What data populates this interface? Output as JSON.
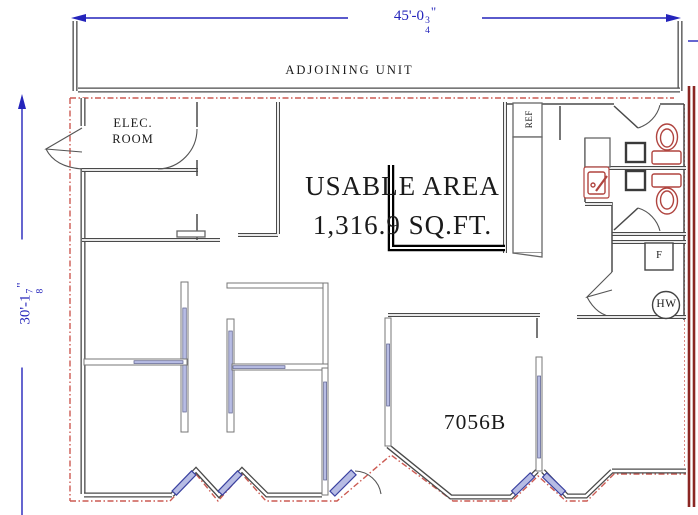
{
  "drawing": {
    "unit_number": "7056B",
    "usable_area": {
      "line1": "USABLE AREA",
      "line2": "1,316.9 SQ.FT."
    },
    "adjoining_unit_label": "ADJOINING UNIT",
    "elec_room": {
      "line1": "ELEC.",
      "line2": "ROOM"
    },
    "fixtures": {
      "refrigerator": "REF",
      "furnace": "F",
      "water_heater": "HW"
    },
    "dimensions": {
      "width": {
        "feet": "45'-0",
        "numerator": "3",
        "denominator": "4",
        "unit_mark": "\""
      },
      "height": {
        "feet": "30'-1",
        "numerator": "7",
        "denominator": "8",
        "unit_mark": "\""
      }
    }
  },
  "colors": {
    "dimension_blue": "#2424bb",
    "wall_gray": "#4a4a4a",
    "demising_red": "#cc5a52",
    "lease_line_dark_red": "#8b2623",
    "partition_blue": "#b7bce4",
    "glazing_blue": "#3a41a0",
    "fixture_red": "#b0443f",
    "text_black": "#1a1a1a"
  }
}
